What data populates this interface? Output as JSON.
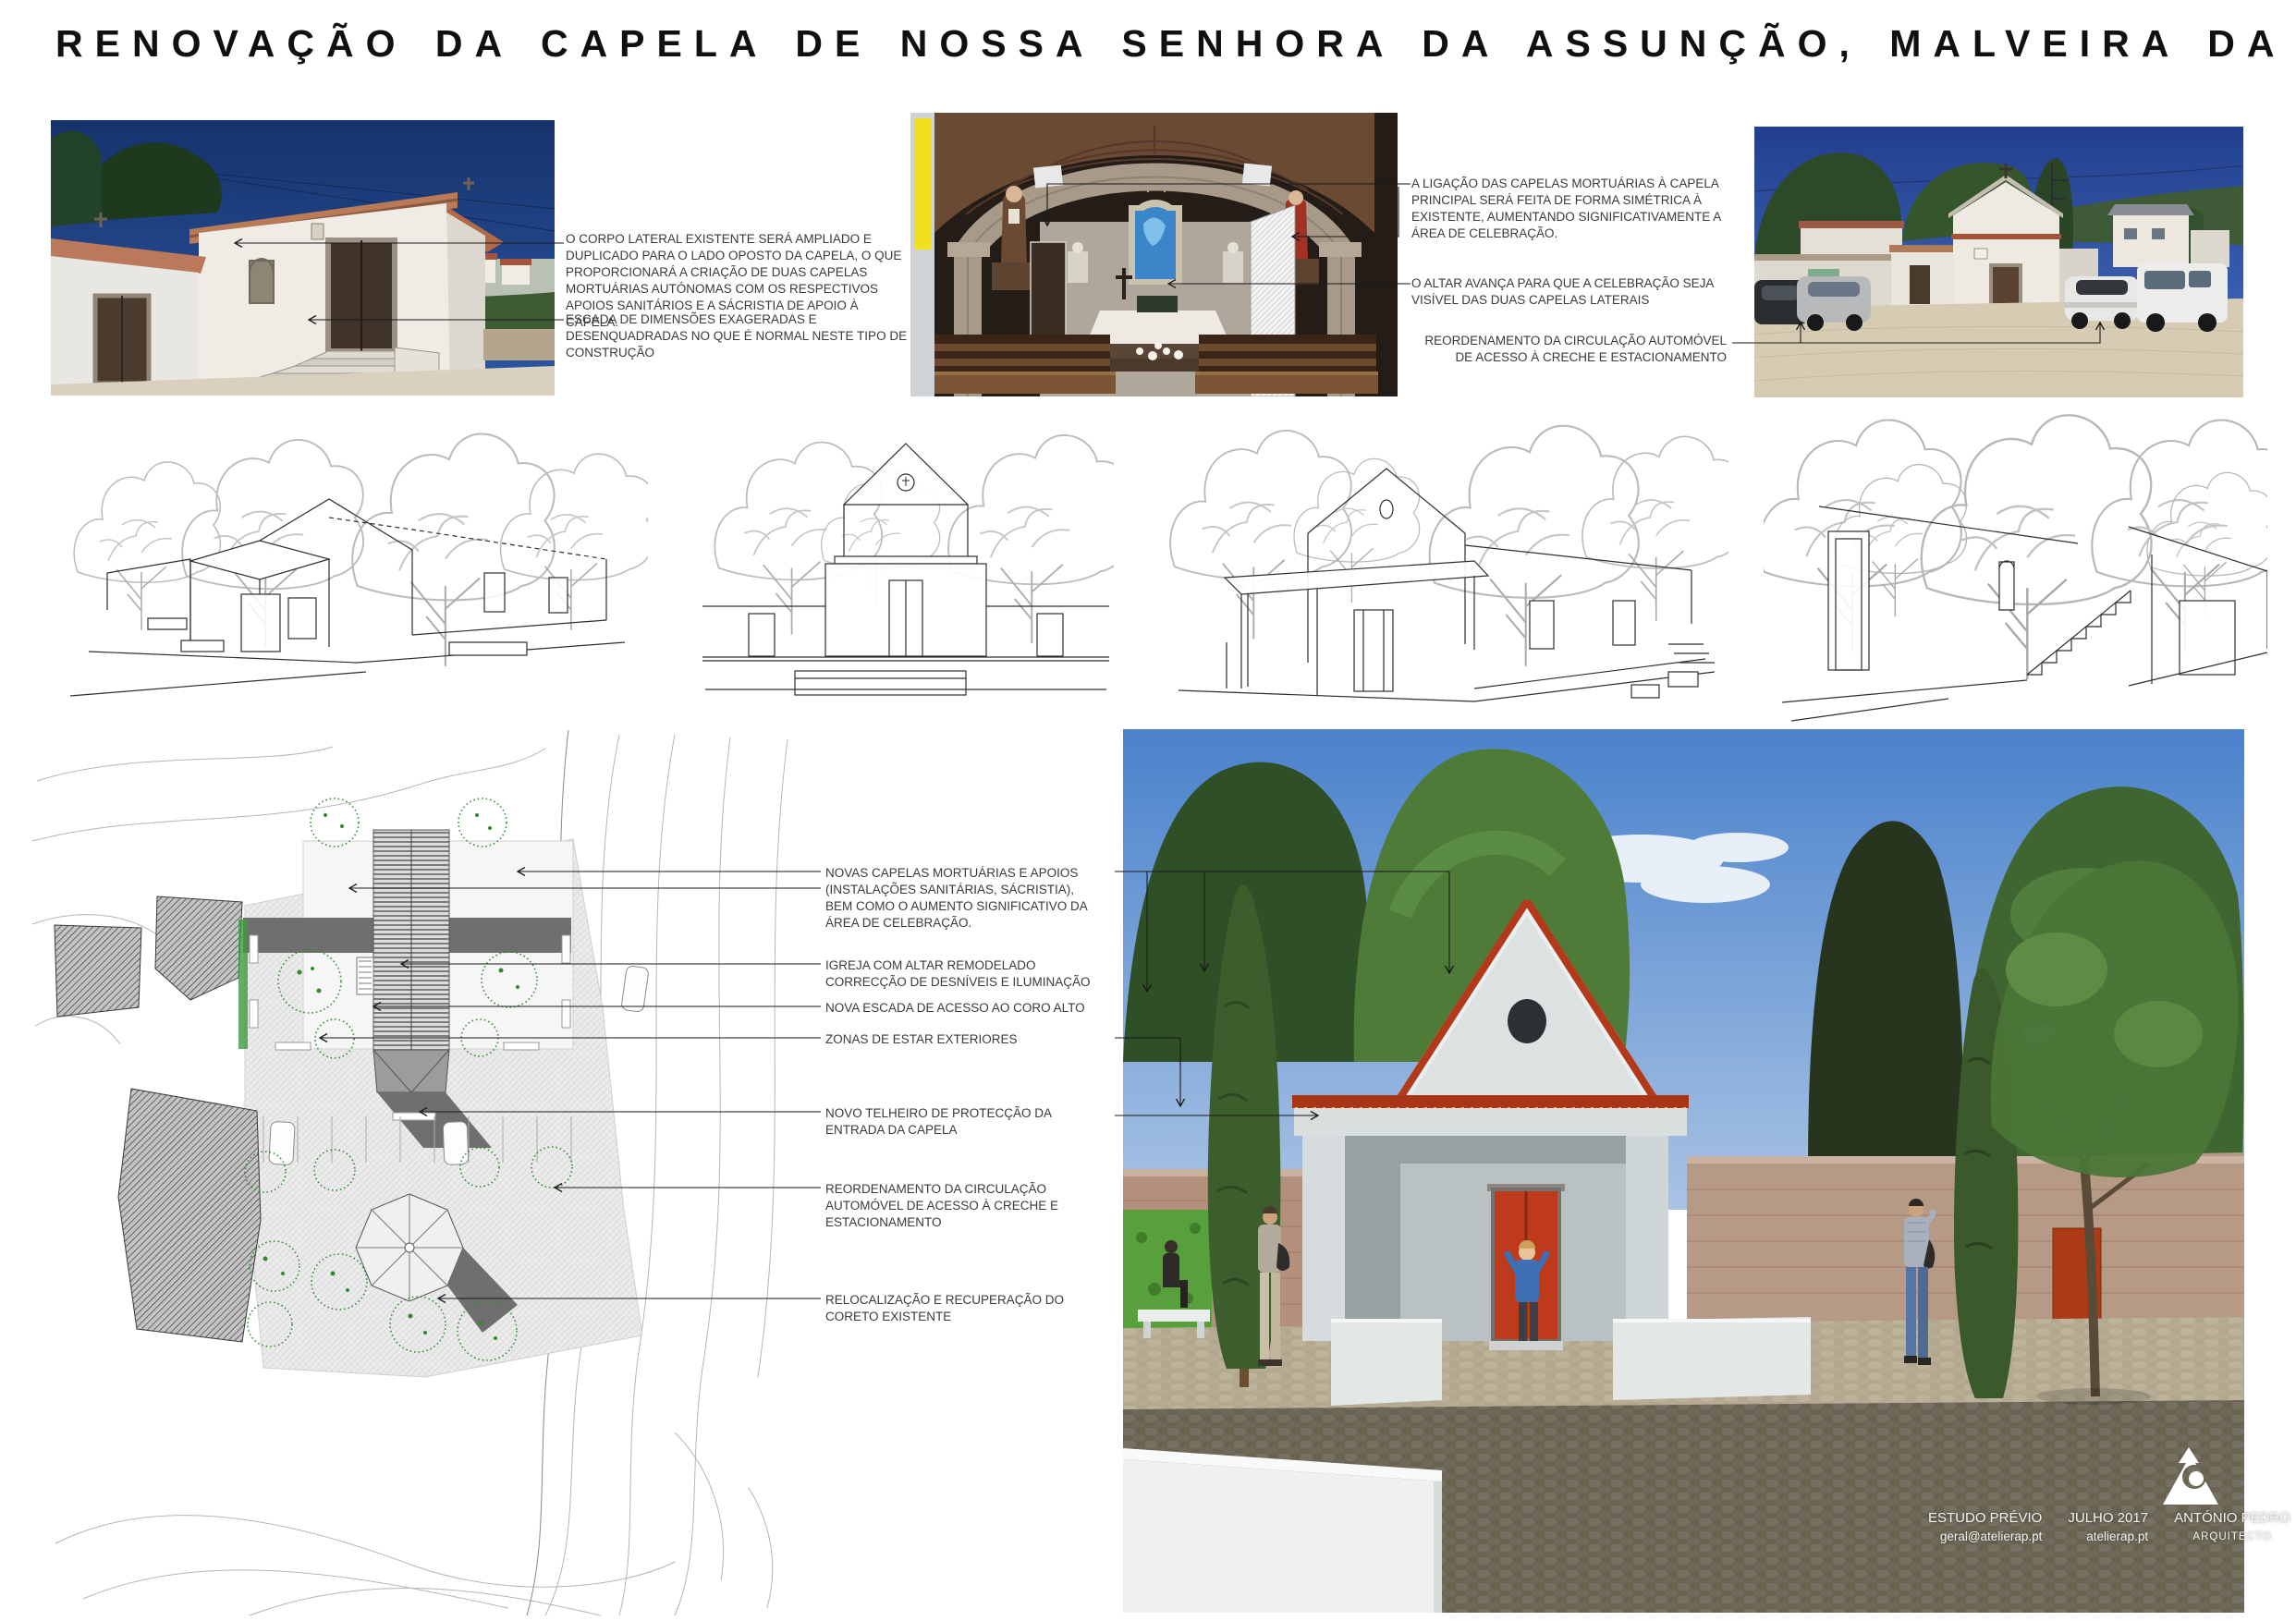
{
  "page_title": "RENOVAÇÃO DA CAPELA DE NOSSA SENHORA DA ASSUNÇÃO, MALVEIRA DA SERRA",
  "photo_row": {
    "left_annotations": [
      "O CORPO LATERAL EXISTENTE SERÁ AMPLIADO E DUPLICADO PARA O LADO OPOSTO DA CAPELA, O QUE PROPORCIONARÁ A CRIAÇÃO DE DUAS CAPELAS MORTUÁRIAS AUTÓNOMAS COM OS RESPECTIVOS APOIOS SANITÁRIOS E A SÁCRISTIA DE APOIO À CAPELA.",
      "ESCADA DE DIMENSÕES EXAGERADAS E DESENQUADRADAS NO QUE É NORMAL NESTE TIPO DE CONSTRUÇÃO"
    ],
    "middle_annotations": [
      "A LIGAÇÃO DAS CAPELAS MORTUÁRIAS À CAPELA PRINCIPAL SERÁ FEITA DE FORMA SIMÉTRICA À EXISTENTE, AUMENTANDO SIGNIFICATIVAMENTE A ÁREA DE CELEBRAÇÃO.",
      "O ALTAR AVANÇA PARA QUE A CELEBRAÇÃO SEJA VISÍVEL DAS DUAS CAPELAS LATERAIS",
      "REORDENAMENTO DA CIRCULAÇÃO AUTOMÓVEL DE ACESSO À CRECHE E ESTACIONAMENTO"
    ]
  },
  "plan_annotations": [
    "NOVAS CAPELAS MORTUÁRIAS E APOIOS (INSTALAÇÕES SANITÁRIAS, SÁCRISTIA), BEM COMO O AUMENTO SIGNIFICATIVO DA ÁREA DE CELEBRAÇÃO.",
    "IGREJA COM ALTAR REMODELADO CORRECÇÃO DE DESNÍVEIS E ILUMINAÇÃO",
    "NOVA ESCADA DE ACESSO AO CORO ALTO",
    "ZONAS DE ESTAR EXTERIORES",
    "NOVO TELHEIRO DE PROTECÇÃO DA ENTRADA DA CAPELA",
    "REORDENAMENTO DA CIRCULAÇÃO AUTOMÓVEL DE ACESSO À CRECHE E ESTACIONAMENTO",
    "RELOCALIZAÇÃO E RECUPERAÇÃO DO CORETO EXISTENTE"
  ],
  "footer": {
    "phase_label": "ESTUDO PRÉVIO",
    "email": "geral@atelierap.pt",
    "date": "JULHO 2017",
    "website": "atelierap.pt",
    "architect_name": "ANTÓNIO PEDRO",
    "architect_title": "ARQUITECTO"
  },
  "palette": {
    "sky_blue": "#4a82cc",
    "deep_photo_blue": "#1e3f7d",
    "roof_red": "#b23a1a",
    "door_red": "#bf3a1b",
    "render_tree_green": "#3f6630",
    "plan_tree_green": "#2e8b2e",
    "stone_wall_pink": "#b2907c"
  }
}
